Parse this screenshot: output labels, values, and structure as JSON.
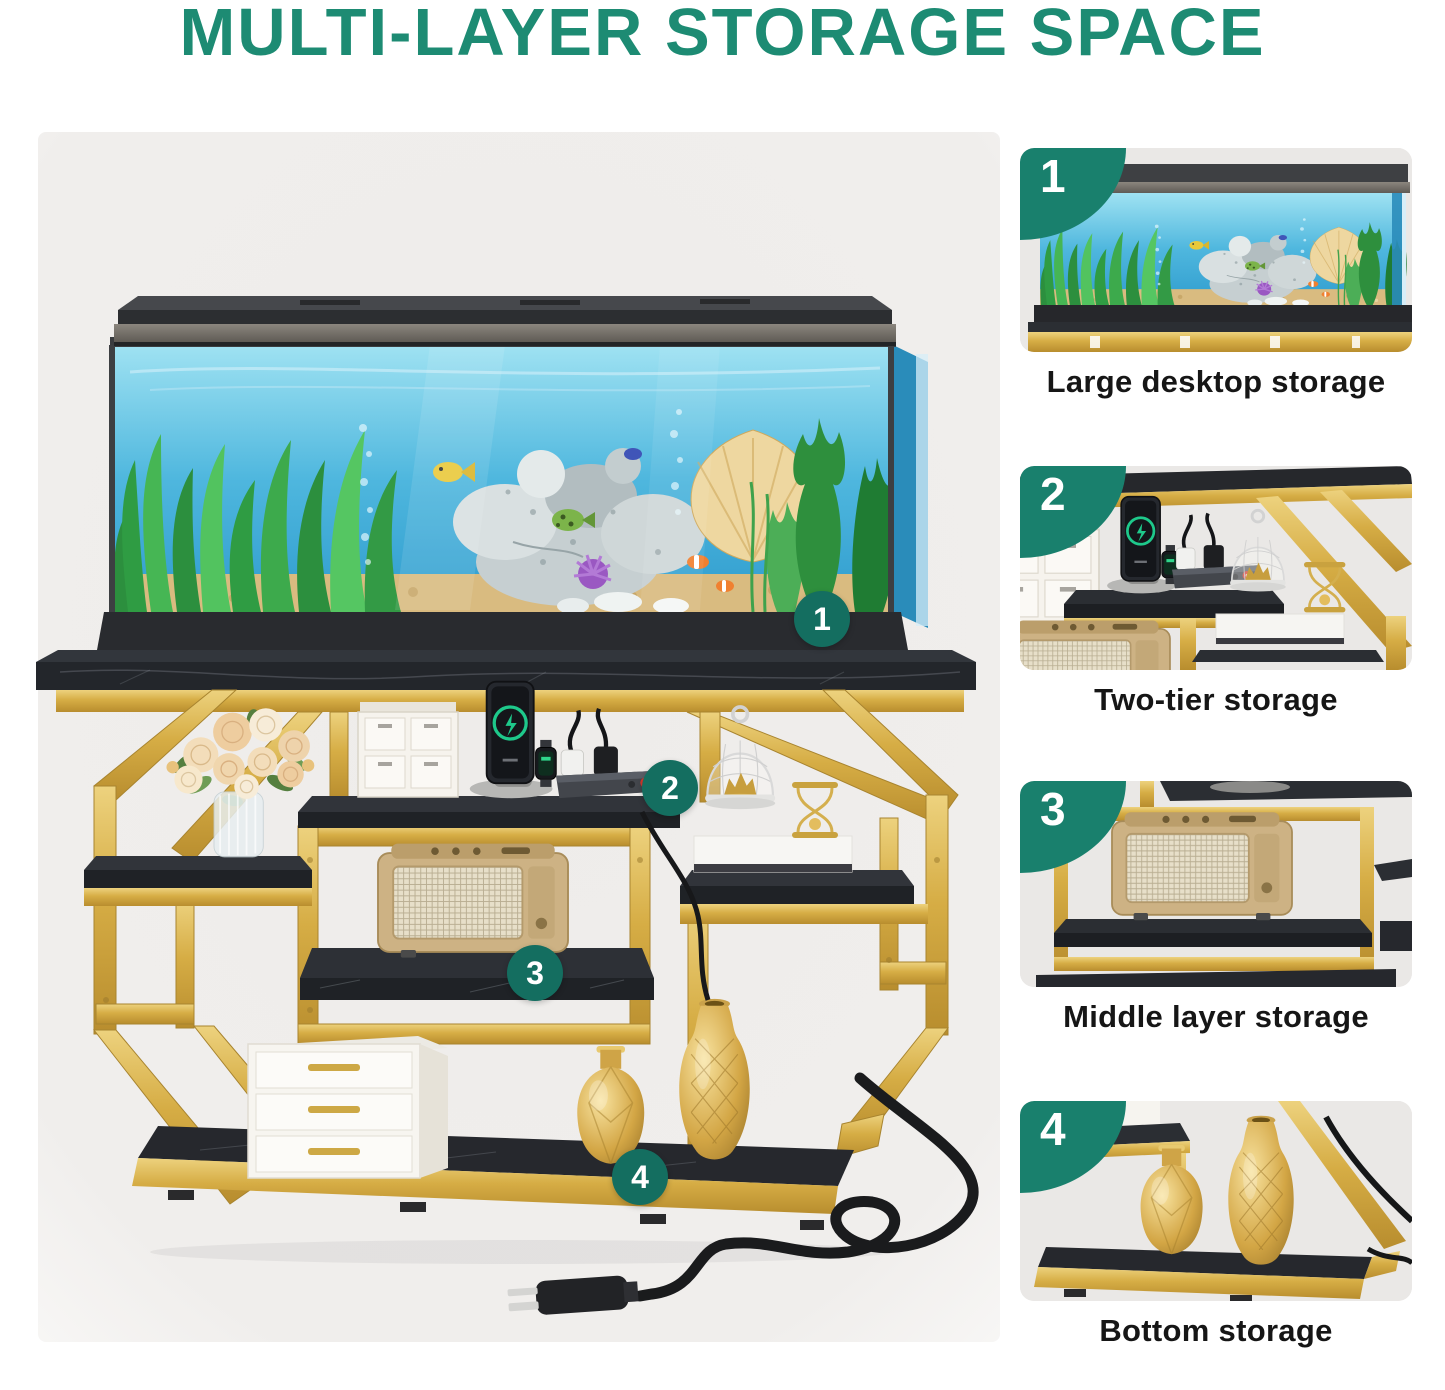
{
  "title": {
    "text": "MULTI-LAYER STORAGE SPACE",
    "color": "#1D8B73"
  },
  "main_figure": {
    "callouts": [
      {
        "number": "1"
      },
      {
        "number": "2"
      },
      {
        "number": "3"
      },
      {
        "number": "4"
      }
    ]
  },
  "features": [
    {
      "number": "1",
      "caption": "Large desktop storage"
    },
    {
      "number": "2",
      "caption": "Two-tier storage"
    },
    {
      "number": "3",
      "caption": "Middle layer storage"
    },
    {
      "number": "4",
      "caption": "Bottom storage"
    }
  ],
  "colors": {
    "accent_teal": "#1D8B73",
    "badge_teal": "#19806D",
    "callout_teal": "#146E60",
    "gold": "#D8AE45",
    "marble_black": "#23262B",
    "photo_background": "#EDEBE9"
  }
}
